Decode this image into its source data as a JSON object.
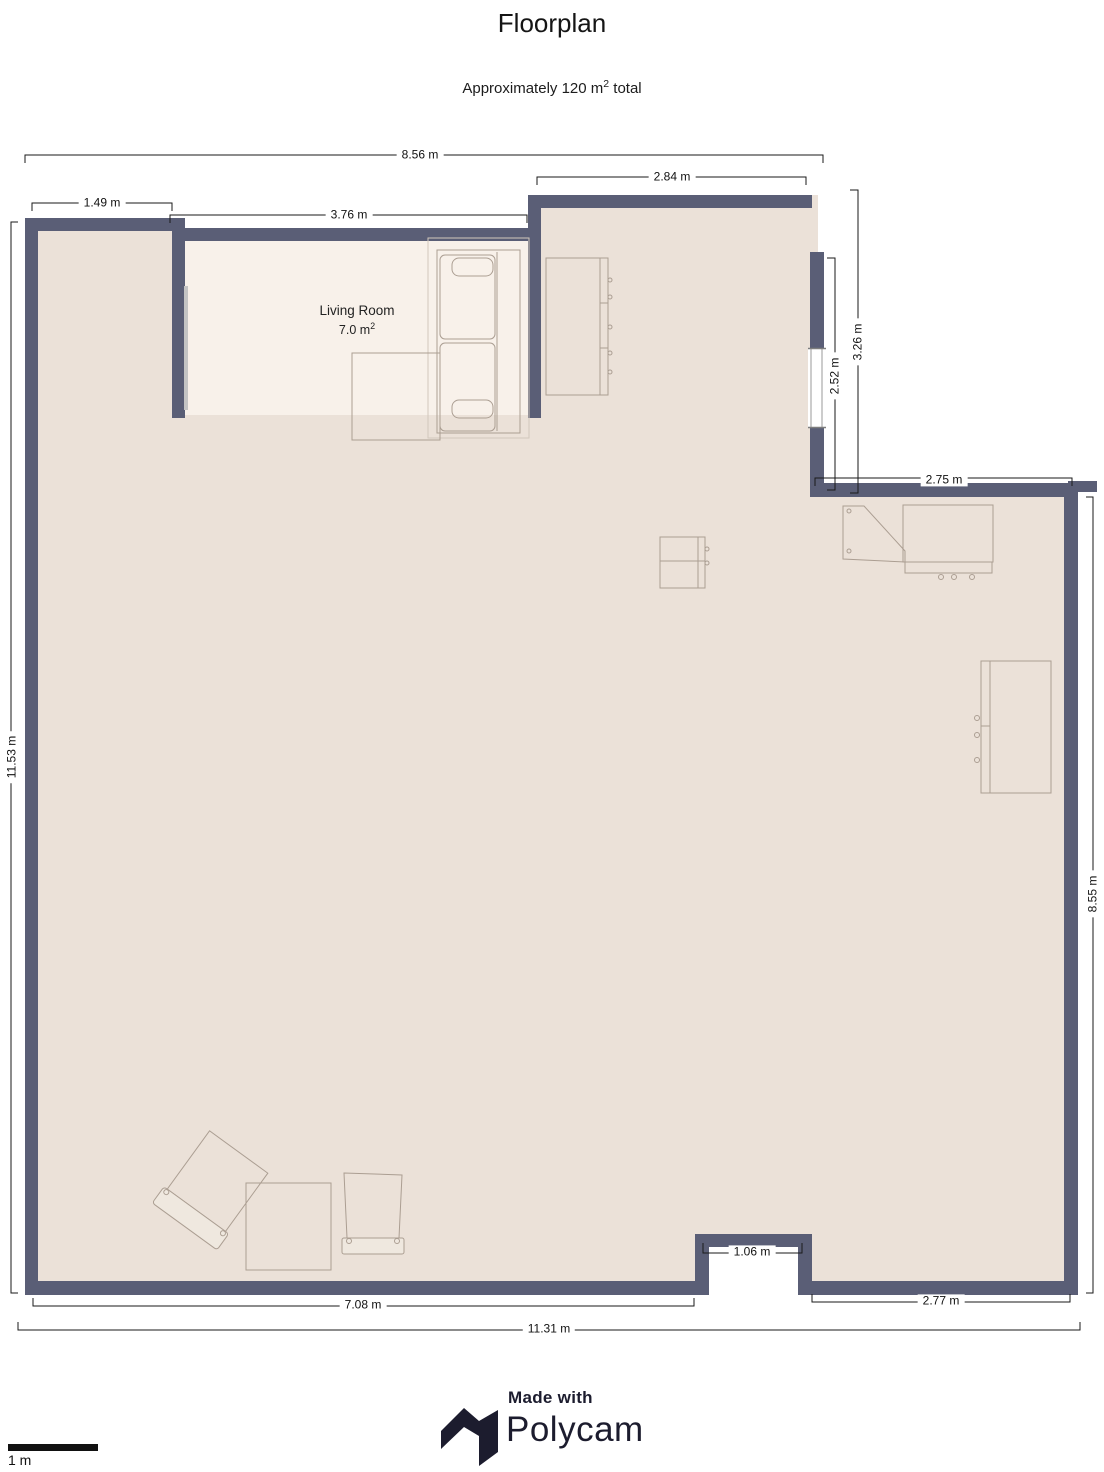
{
  "title": "Floorplan",
  "subtitle": {
    "prefix": "Approximately 120 m",
    "sup": "2",
    "suffix": " total"
  },
  "living_room": {
    "name": "Living Room",
    "area": "7.0 m",
    "area_sup": "2"
  },
  "dimensions": {
    "top_width": "8.56 m",
    "upper_right_width": "2.84 m",
    "nook_width": "1.49 m",
    "living_room_width": "3.76 m",
    "right_wing_height": "3.26 m",
    "window_height": "2.52 m",
    "right_wing_width": "2.75 m",
    "left_height": "11.53 m",
    "right_height": "8.55 m",
    "door_width": "1.06 m",
    "bottom_left_width": "7.08 m",
    "bottom_right_width": "2.77 m",
    "total_width": "11.31 m"
  },
  "scale": {
    "label": "1 m"
  },
  "branding": {
    "made_with": "Made with",
    "brand": "Polycam"
  },
  "colors": {
    "wall": "#5a5e76",
    "floor": "#ebe1d8",
    "living_room_floor": "#f8f1ea",
    "furniture": "#ab9e92",
    "dimension_text": "#111111",
    "logo": "#1c1c2e"
  }
}
